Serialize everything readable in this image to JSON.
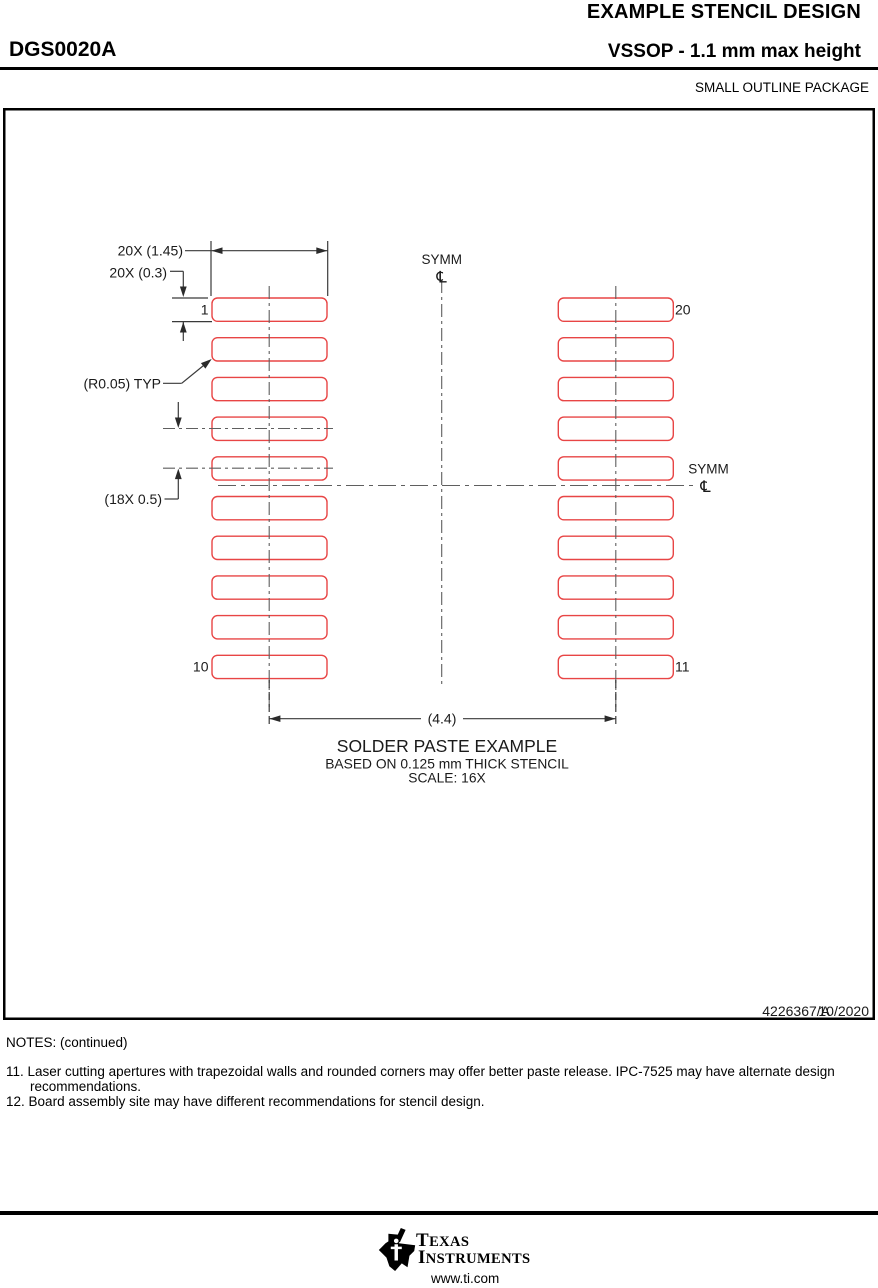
{
  "header": {
    "title": "EXAMPLE STENCIL DESIGN",
    "part_number": "DGS0020A",
    "subtitle": "VSSOP - 1.1 mm max height",
    "package_type": "SMALL OUTLINE PACKAGE"
  },
  "diagram": {
    "pad_color": "#e84545",
    "labels": {
      "aperture_width": "20X (1.45)",
      "aperture_height": "20X (0.3)",
      "corner_radius": "(R0.05) TYP",
      "pitch": "(18X 0.5)",
      "span": "(4.4)",
      "symm_top": "SYMM",
      "symm_right": "SYMM",
      "centerline_symbol": "℄",
      "pin_1": "1",
      "pin_10": "10",
      "pin_11": "11",
      "pin_20": "20"
    },
    "caption": {
      "line1": "SOLDER PASTE EXAMPLE",
      "line2": "BASED ON 0.125 mm THICK STENCIL",
      "line3": "SCALE: 16X"
    },
    "doc_number": "4226367/A",
    "doc_date": "10/2020"
  },
  "notes": {
    "heading": "NOTES: (continued)",
    "items": [
      {
        "number": "11.",
        "text": "Laser cutting apertures with trapezoidal walls and rounded corners may offer better paste release. IPC-7525 may have alternate design recommendations."
      },
      {
        "number": "12.",
        "text": "Board assembly site may have different recommendations for stencil design."
      }
    ]
  },
  "footer": {
    "brand_line1": "TEXAS",
    "brand_line2": "INSTRUMENTS",
    "website": "www.ti.com"
  }
}
